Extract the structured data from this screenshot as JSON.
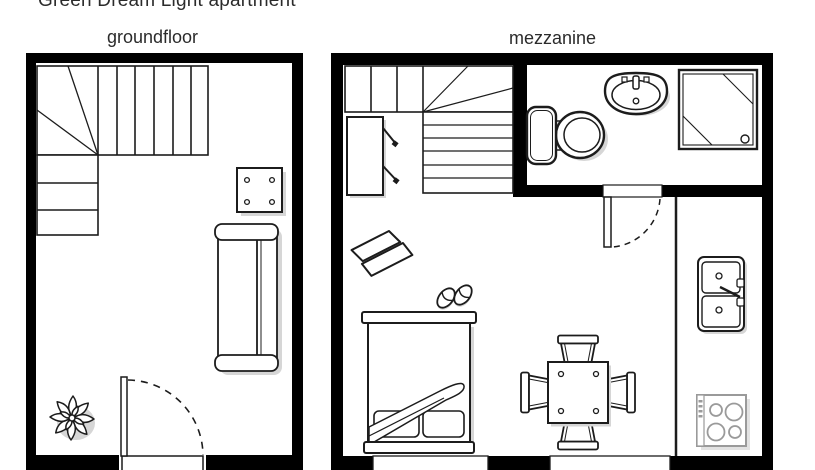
{
  "title": "Green Dream Light apartment",
  "plans": [
    {
      "id": "groundfloor",
      "label": "groundfloor",
      "features": [
        "l-shaped-staircase",
        "square-table",
        "sofa",
        "plant",
        "entrance-door-with-swing",
        "doorstep"
      ]
    },
    {
      "id": "mezzanine",
      "label": "mezzanine",
      "rooms": [
        "bathroom",
        "kitchen",
        "sleeping-area"
      ],
      "features": [
        "l-shaped-staircase",
        "wardrobe",
        "armchair",
        "slippers",
        "double-bed-with-pillows-and-blanket",
        "dining-table-with-four-chairs",
        "bathroom-door-with-swing",
        "toilet",
        "washbasin",
        "shower-cabin",
        "double-kitchen-sink",
        "stove-with-four-burners",
        "two-windows"
      ]
    }
  ],
  "colors": {
    "wall": "#000000",
    "background": "#ffffff",
    "line": "#1c1c1c",
    "shadow": "#d6d6d6",
    "appliance_gray": "#9a9a9a",
    "text": "#2b2b2b"
  }
}
